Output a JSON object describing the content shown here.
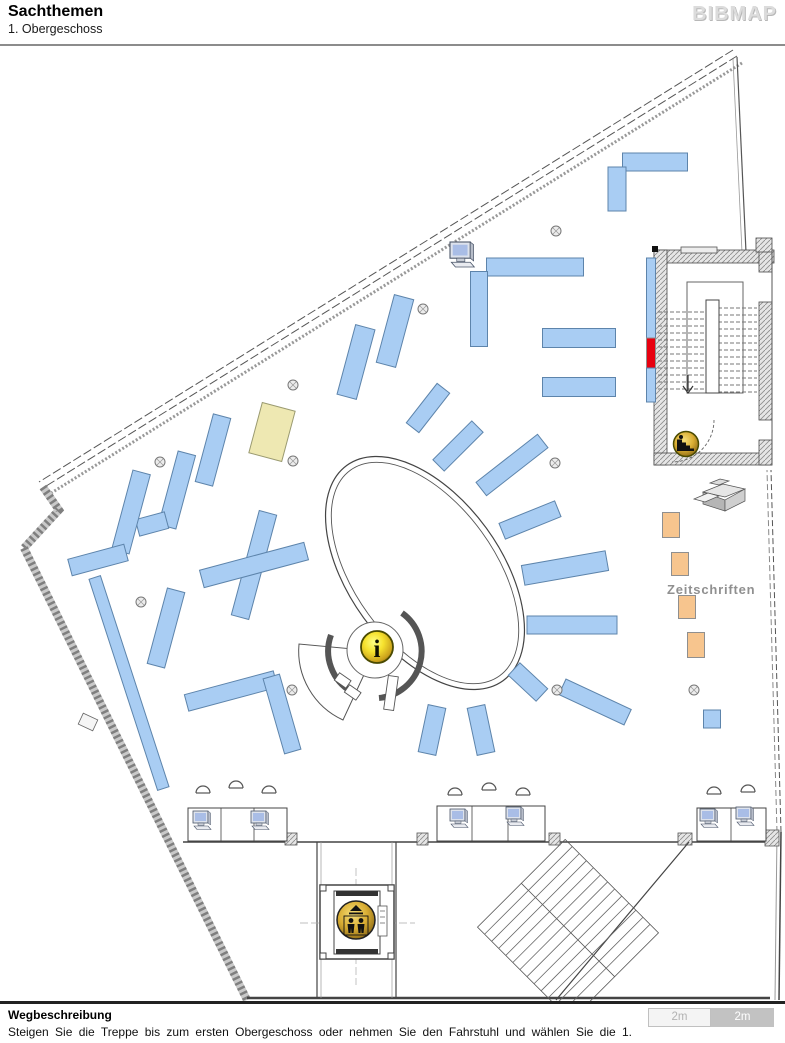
{
  "header": {
    "title": "Sachthemen",
    "subtitle": "1. Obergeschoss",
    "logo": "BIBMAP"
  },
  "footer": {
    "heading": "Wegbeschreibung",
    "description": "Steigen Sie die Treppe bis zum ersten Obergeschoss oder nehmen Sie den Fahrstuhl und wählen Sie die 1.",
    "scale": {
      "left": "2m",
      "right": "2m"
    }
  },
  "map": {
    "label_zeitschriften": "Zeitschriften",
    "info_letter": "i",
    "icons": [
      "info-icon",
      "elevator-icon",
      "stairs-icon",
      "computer-icon",
      "copier-icon"
    ],
    "colors": {
      "shelf_blue": "#a9cdf3",
      "shelf_blue_stroke": "#5d84ab",
      "shelf_yellow": "#eee8b2",
      "shelf_yellow_stroke": "#9a9a70",
      "rack_orange": "#f7c58e",
      "rack_orange_stroke": "#8f8f8f",
      "highlight_red": "#e8000f",
      "highlight_red_stroke": "#8f8f8f",
      "icon_gold": "#e7b93c",
      "wall": "#555555"
    },
    "shelves": [
      {
        "x": 655,
        "y": 162,
        "w": 65,
        "h": 18,
        "r": 0,
        "c": "blue"
      },
      {
        "x": 617,
        "y": 189,
        "w": 18,
        "h": 44,
        "r": 0,
        "c": "blue"
      },
      {
        "x": 535,
        "y": 267,
        "w": 97,
        "h": 18,
        "r": 0,
        "c": "blue"
      },
      {
        "x": 479,
        "y": 309,
        "w": 17,
        "h": 75,
        "r": 0,
        "c": "blue"
      },
      {
        "x": 579,
        "y": 338,
        "w": 73,
        "h": 19,
        "r": 0,
        "c": "blue"
      },
      {
        "x": 579,
        "y": 387,
        "w": 73,
        "h": 19,
        "r": 0,
        "c": "blue"
      },
      {
        "x": 651,
        "y": 298,
        "w": 9,
        "h": 80,
        "r": 0,
        "c": "blue"
      },
      {
        "x": 651,
        "y": 353,
        "w": 9,
        "h": 30,
        "r": 0,
        "c": "red"
      },
      {
        "x": 651,
        "y": 385,
        "w": 9,
        "h": 34,
        "r": 0,
        "c": "blue"
      },
      {
        "x": 712,
        "y": 719,
        "w": 17,
        "h": 18,
        "r": 0,
        "c": "blue"
      },
      {
        "x": 572,
        "y": 625,
        "w": 90,
        "h": 18,
        "r": 0,
        "c": "blue"
      },
      {
        "x": 213,
        "y": 450,
        "w": 18,
        "h": 70,
        "r": 15,
        "c": "blue"
      },
      {
        "x": 177,
        "y": 490,
        "w": 18,
        "h": 76,
        "r": 15,
        "c": "blue"
      },
      {
        "x": 152,
        "y": 524,
        "w": 17,
        "h": 30,
        "r": 75,
        "c": "blue"
      },
      {
        "x": 131,
        "y": 512,
        "w": 18,
        "h": 82,
        "r": 15,
        "c": "blue"
      },
      {
        "x": 98,
        "y": 560,
        "w": 17,
        "h": 58,
        "r": 75,
        "c": "blue"
      },
      {
        "x": 272,
        "y": 432,
        "w": 34,
        "h": 52,
        "r": 15,
        "c": "yellow"
      },
      {
        "x": 356,
        "y": 362,
        "w": 20,
        "h": 72,
        "r": 15,
        "c": "blue"
      },
      {
        "x": 395,
        "y": 331,
        "w": 20,
        "h": 70,
        "r": 15,
        "c": "blue"
      },
      {
        "x": 254,
        "y": 565,
        "w": 18,
        "h": 108,
        "r": 15,
        "c": "blue"
      },
      {
        "x": 254,
        "y": 565,
        "w": 18,
        "h": 108,
        "r": 75,
        "c": "blue"
      },
      {
        "x": 166,
        "y": 628,
        "w": 18,
        "h": 78,
        "r": 15,
        "c": "blue"
      },
      {
        "x": 231,
        "y": 691,
        "w": 17,
        "h": 92,
        "r": 75,
        "c": "blue"
      },
      {
        "x": 282,
        "y": 714,
        "w": 17,
        "h": 78,
        "r": -16,
        "c": "blue"
      },
      {
        "x": 129,
        "y": 683,
        "w": 12,
        "h": 222,
        "r": -18,
        "c": "blue"
      },
      {
        "x": 432,
        "y": 730,
        "w": 18,
        "h": 48,
        "r": 12,
        "c": "blue"
      },
      {
        "x": 481,
        "y": 730,
        "w": 18,
        "h": 48,
        "r": -12,
        "c": "blue"
      },
      {
        "x": 428,
        "y": 408,
        "w": 16,
        "h": 50,
        "r": 38,
        "c": "blue"
      },
      {
        "x": 458,
        "y": 446,
        "w": 16,
        "h": 55,
        "r": 45,
        "c": "blue"
      },
      {
        "x": 512,
        "y": 465,
        "w": 17,
        "h": 78,
        "r": 52,
        "c": "blue"
      },
      {
        "x": 530,
        "y": 520,
        "w": 17,
        "h": 60,
        "r": 68,
        "c": "blue"
      },
      {
        "x": 565,
        "y": 568,
        "w": 20,
        "h": 85,
        "r": 80,
        "c": "blue"
      },
      {
        "x": 528,
        "y": 682,
        "w": 17,
        "h": 38,
        "r": 133,
        "c": "blue"
      },
      {
        "x": 595,
        "y": 702,
        "w": 17,
        "h": 72,
        "r": 115,
        "c": "blue"
      },
      {
        "x": 671,
        "y": 525,
        "w": 17,
        "h": 25,
        "r": 0,
        "c": "orange"
      },
      {
        "x": 680,
        "y": 564,
        "w": 17,
        "h": 23,
        "r": 0,
        "c": "orange"
      },
      {
        "x": 687,
        "y": 607,
        "w": 17,
        "h": 23,
        "r": 0,
        "c": "orange"
      },
      {
        "x": 696,
        "y": 645,
        "w": 17,
        "h": 25,
        "r": 0,
        "c": "orange"
      }
    ],
    "columns": [
      [
        556,
        231
      ],
      [
        423,
        309
      ],
      [
        293,
        385
      ],
      [
        160,
        462
      ],
      [
        293,
        461
      ],
      [
        555,
        463
      ],
      [
        141,
        602
      ],
      [
        292,
        690
      ],
      [
        557,
        690
      ],
      [
        694,
        690
      ]
    ],
    "desks": [
      {
        "x": 188,
        "y": 808,
        "w": 99,
        "h": 33,
        "div": [
          221,
          254
        ]
      },
      {
        "x": 437,
        "y": 806,
        "w": 108,
        "h": 35,
        "div": [
          472,
          508
        ]
      },
      {
        "x": 697,
        "y": 808,
        "w": 69,
        "h": 33,
        "div": [
          731
        ]
      }
    ],
    "computers": [
      {
        "x": 193,
        "y": 811,
        "s": 1
      },
      {
        "x": 251,
        "y": 811,
        "s": 1
      },
      {
        "x": 450,
        "y": 809,
        "s": 1
      },
      {
        "x": 506,
        "y": 807,
        "s": 1
      },
      {
        "x": 700,
        "y": 809,
        "s": 1
      },
      {
        "x": 736,
        "y": 807,
        "s": 1
      },
      {
        "x": 450,
        "y": 242,
        "s": 1.35
      }
    ],
    "chairs": [
      [
        203,
        790
      ],
      [
        236,
        785
      ],
      [
        269,
        790
      ],
      [
        455,
        792
      ],
      [
        489,
        787
      ],
      [
        523,
        792
      ],
      [
        714,
        791
      ],
      [
        748,
        789
      ]
    ]
  }
}
